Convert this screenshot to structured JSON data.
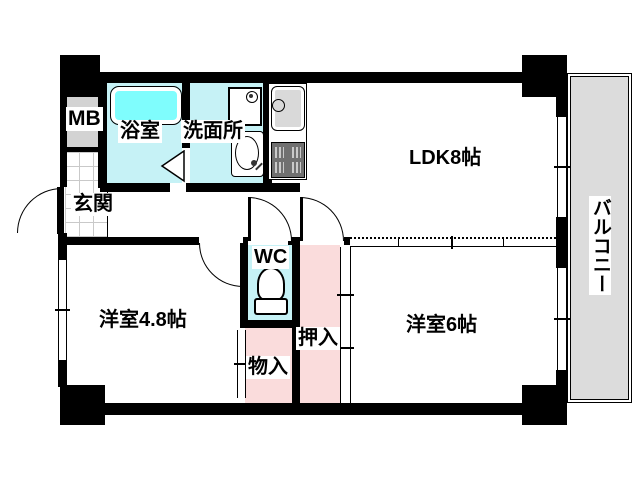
{
  "rooms": {
    "mb": {
      "label": "MB"
    },
    "bathroom": {
      "label": "浴室"
    },
    "washroom": {
      "label": "洗面所"
    },
    "ldk": {
      "label": "LDK8帖"
    },
    "entrance": {
      "label": "玄関"
    },
    "wc": {
      "label": "WC"
    },
    "western_room_4_8": {
      "label": "洋室4.8帖"
    },
    "storage": {
      "label": "物入"
    },
    "closet": {
      "label": "押入"
    },
    "western_room_6": {
      "label": "洋室6帖"
    },
    "balcony": {
      "label": "バルコニー"
    }
  },
  "colors": {
    "wood": "#fbdcb5",
    "floor_line": "#4f4f4f",
    "wet_floor": "#c6f2f6",
    "bathtub": "#7ffdfd",
    "closet_pink": "#fadcdc",
    "mb_gray": "#d3d3d3",
    "balcony_gray": "#dcdcdc",
    "tile_line": "#c9c9c9",
    "wall": "#000000"
  }
}
